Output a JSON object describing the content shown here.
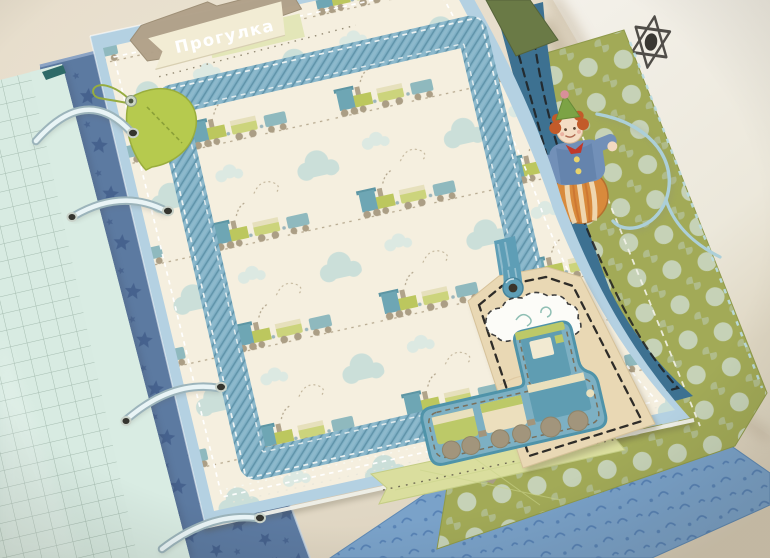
{
  "banner": {
    "title": "Прогулка"
  },
  "scene": {
    "description": "Photograph of a handmade baby-boy scrapbook album page lying on a beige table",
    "album_theme": "trains and clouds",
    "drawn_symbol": "six-pointed star doodle on white panel"
  },
  "palette": {
    "table": "#e6ddcb",
    "white_panel": "#f1eee5",
    "mint_grid_page": "#d8ebe2",
    "star_page": "#5c7aa1",
    "page_base_blue": "#b4d1e2",
    "cream_train_paper": "#f5efdf",
    "frame_blue": "#7fb0c5",
    "leaf_green": "#b6ca4e",
    "tag_tan": "#e9d8b4",
    "dark_blue_sheet": "#3d7191",
    "polka_olive": "#a2aa57",
    "squiggle_blue": "#7aa2c9",
    "banner_cream": "#f2ecd4",
    "banner_kraft": "#b1a189",
    "celery_banner": "#dade9e",
    "train_teal": "#5f9db2",
    "train_green": "#bcc968",
    "wheel_taupe": "#a2957c",
    "ring_blue": "#e9f4f6"
  }
}
